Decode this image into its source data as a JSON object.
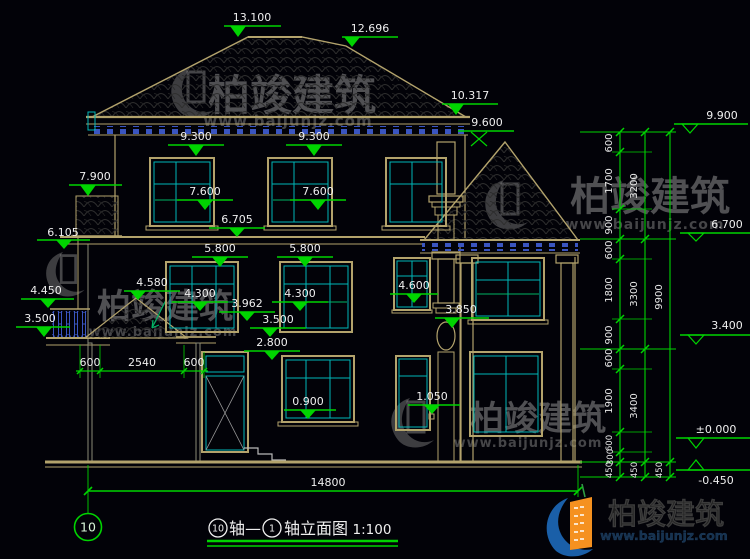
{
  "palette": {
    "background": "#020208",
    "dim_green": "#00d400",
    "wall_tan": "#b3a36c",
    "window_cyan": "#00b7b7",
    "detail_blue": "#3a55c0",
    "text_white": "#efefef",
    "watermark_gray": "#9e9e9e",
    "logo_blue": "#1a5fa8",
    "logo_orange": "#f59120"
  },
  "markers": {
    "m13100": "13.100",
    "m12696": "12.696",
    "m10317": "10.317",
    "m9600": "9.600",
    "m9300a": "9.300",
    "m9300b": "9.300",
    "m7900": "7.900",
    "m7600a": "7.600",
    "m7600b": "7.600",
    "m6705": "6.705",
    "m6105": "6.105",
    "m5800a": "5.800",
    "m5800b": "5.800",
    "m4580": "4.580",
    "m4450": "4.450",
    "m4300a": "4.300",
    "m4300b": "4.300",
    "m4600": "4.600",
    "m3962": "3.962",
    "m3850": "3.850",
    "m3500a": "3.500",
    "m3500b": "3.500",
    "m2800": "2.800",
    "m0900": "0.900",
    "m1050": "1.050",
    "r9900": "9.900",
    "r6700": "6.700",
    "r3400": "3.400",
    "r0000": "±0.000",
    "rm0450": "-0.450"
  },
  "dims": {
    "h": {
      "a600": "600",
      "mid": "2540",
      "b600": "600",
      "total": "14800"
    },
    "va": [
      "600",
      "1700",
      "900",
      "600",
      "1800",
      "900",
      "600",
      "1900",
      "600",
      "300",
      "450"
    ],
    "vb": [
      "3200",
      "3300",
      "3400",
      "450"
    ],
    "vc": [
      "9900",
      "450"
    ]
  },
  "axis": {
    "bubble": "10"
  },
  "title": {
    "b1": "10",
    "t1": "轴—",
    "b2": "1",
    "t2": "轴立面图",
    "scale": "1:100"
  },
  "watermark": {
    "brand": "柏竣建筑",
    "url": "www.baijunjz.com"
  },
  "logo": {
    "brand": "柏竣建筑",
    "url": "www.baijunjz.com"
  }
}
